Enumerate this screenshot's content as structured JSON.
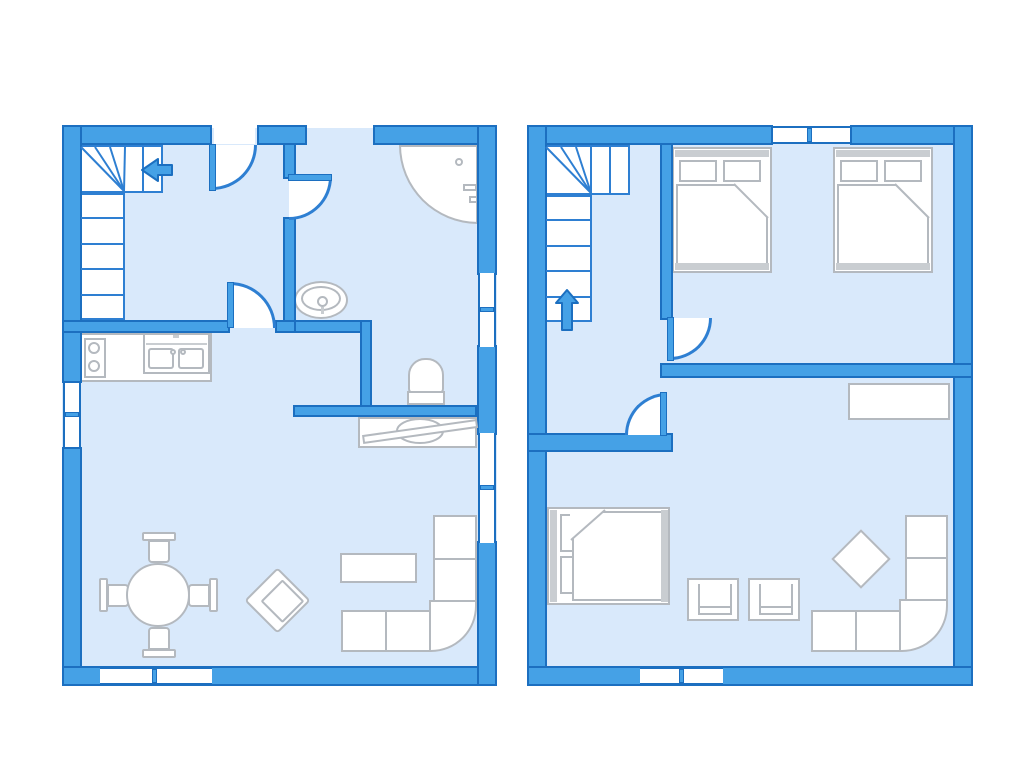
{
  "meta": {
    "type": "floor-plan",
    "description": "Two-level holiday-home floor plan drawn in blue line style, two plans side by side",
    "levels_count": 2
  },
  "colors": {
    "background": "#ffffff",
    "wall_fill": "#45a1e6",
    "wall_stroke": "#1c6fc0",
    "floor_fill": "#d9e9fb",
    "stair_stroke": "#2e7fd2",
    "furniture_stroke": "#b4b9bf",
    "furniture_fill": "#ffffff",
    "fixture_fill": "#c9cdd1",
    "arrow_fill": "#45a1e6"
  },
  "levels": [
    {
      "id": "ground-floor",
      "position": "left",
      "rooms": [
        "entrance-hall",
        "bathroom",
        "toilet-nook",
        "open-kitchen",
        "living-dining-room"
      ],
      "stairs": {
        "shape": "L-winder",
        "direction_arrow": "left"
      },
      "doors": [
        "entrance-door",
        "bathroom-door",
        "hall-to-living-door"
      ],
      "windows_count": 4,
      "furniture": [
        "kitchen-counter-with-stove-and-double-sink",
        "corner-shower",
        "washbasin",
        "toilet",
        "sideboard-with-paddle",
        "round-dining-table",
        "four-dining-chairs",
        "armchair-rotated",
        "coffee-table",
        "corner-sofa"
      ]
    },
    {
      "id": "upper-floor",
      "position": "right",
      "rooms": [
        "stair-landing",
        "double-bedroom",
        "studio-room"
      ],
      "stairs": {
        "shape": "L-winder",
        "direction_arrow": "up"
      },
      "doors": [
        "bedroom-door",
        "studio-door"
      ],
      "windows_count": 2,
      "furniture": [
        "double-bed-1",
        "double-bed-2",
        "single-bed",
        "stool-chair-1",
        "stool-chair-2",
        "diamond-side-table",
        "corner-sofa",
        "wardrobe-shelf"
      ]
    }
  ]
}
